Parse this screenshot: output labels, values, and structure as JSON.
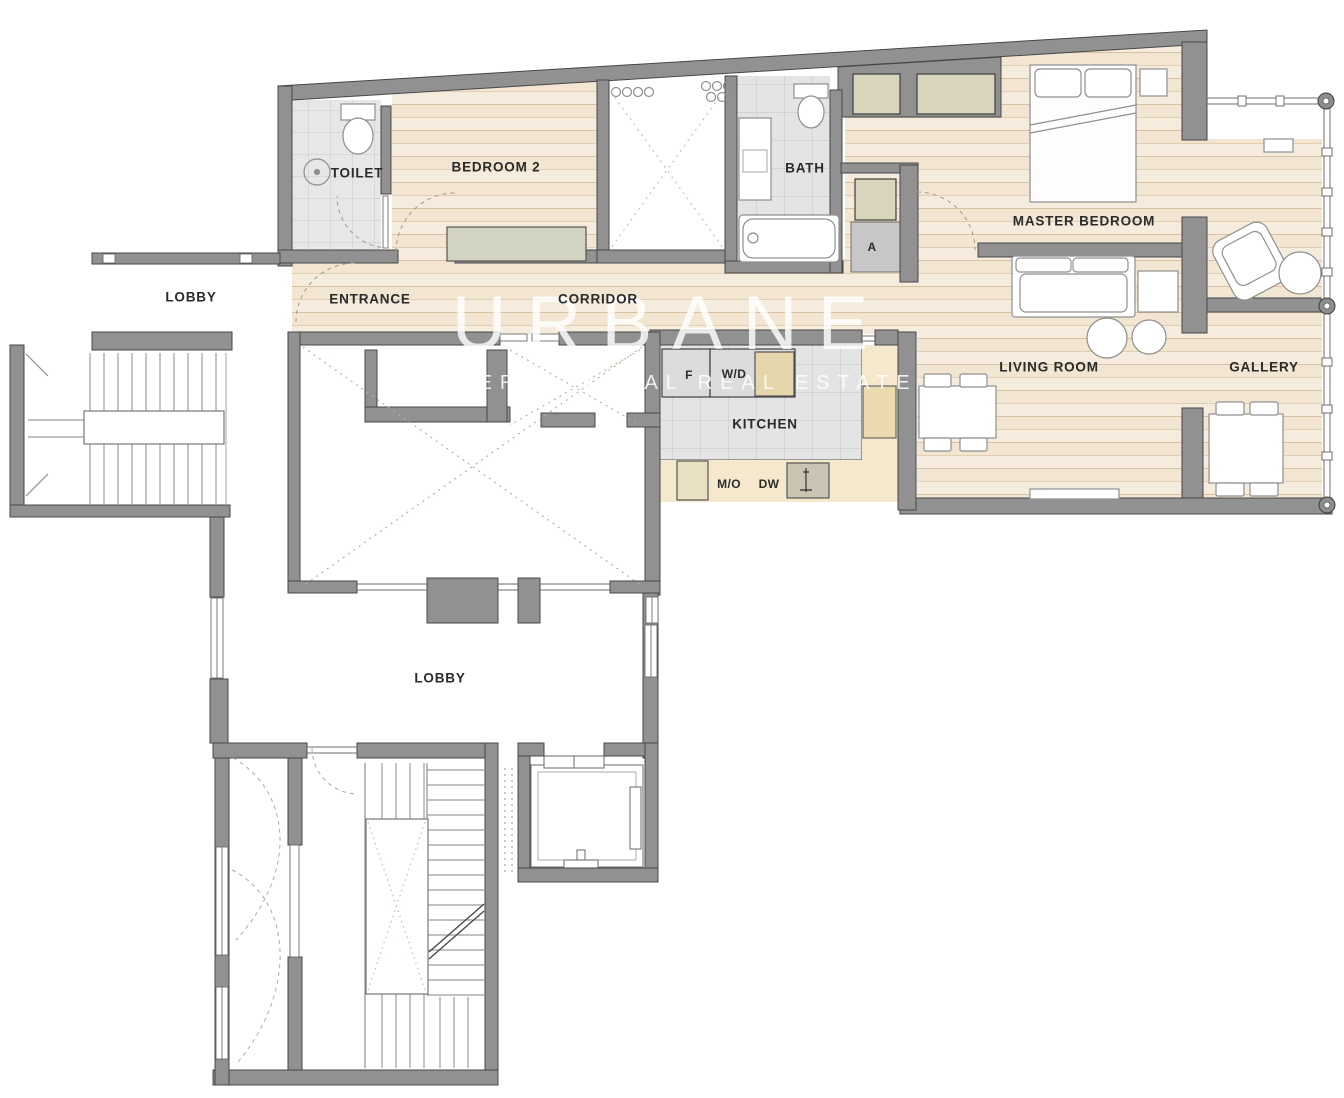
{
  "plan": {
    "watermark": {
      "brand": "URBANE",
      "tagline": "INTERNATIONAL REAL ESTATE"
    },
    "rooms": {
      "toilet": "TOILET",
      "bedroom2": "BEDROOM 2",
      "entrance": "ENTRANCE",
      "corridor": "CORRIDOR",
      "bath": "BATH",
      "utility": "A",
      "master_bedroom": "MASTER BEDROOM",
      "living_room": "LIVING ROOM",
      "gallery": "GALLERY",
      "kitchen": "KITCHEN",
      "lobby_upper": "LOBBY",
      "lobby_lower": "LOBBY"
    },
    "appliances": {
      "fridge": "F",
      "washer_dryer": "W/D",
      "microwave": "M/O",
      "dishwasher": "DW"
    },
    "colors": {
      "wall": "#919191",
      "wall_outline": "#474747",
      "wood_floor": "#f2e5d1",
      "wood_line": "#d8c2a2",
      "tile_floor": "#e4e4e4",
      "tile_line": "#c3c3c3",
      "closet": "#d9d4bc",
      "counter": "#f5e8cc",
      "cabinet": "#ecd9ae",
      "label_text": "#2b2b2b"
    }
  }
}
